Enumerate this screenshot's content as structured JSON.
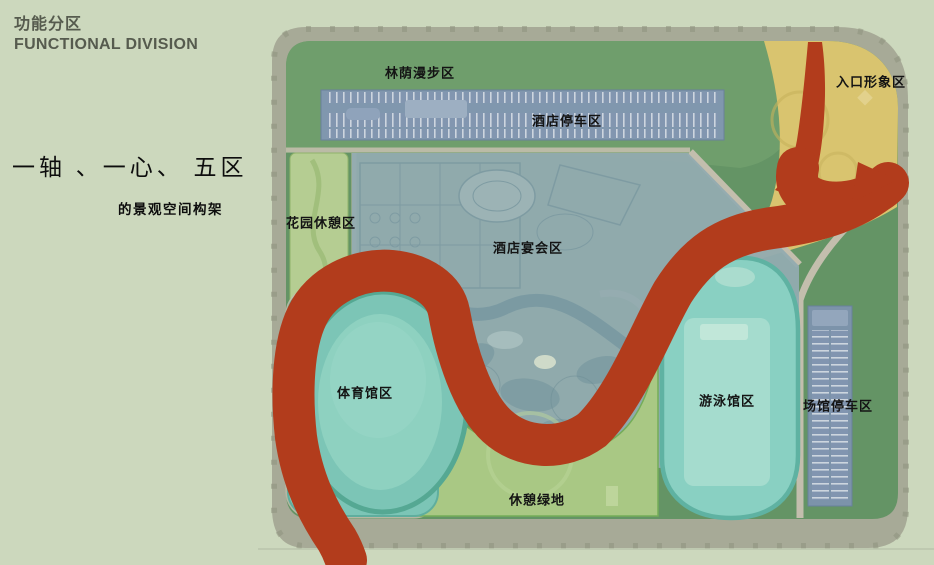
{
  "header": {
    "title_zh": "功能分区",
    "title_en": "FUNCTIONAL DIVISION"
  },
  "headline": {
    "main": "一轴 、一心、 五区",
    "sub": "的景观空间构架"
  },
  "plan": {
    "ribbon_color": "#b23c1c",
    "zones": [
      {
        "id": "stroll",
        "label": "林荫漫步区",
        "color": "#6f9e6c"
      },
      {
        "id": "hotel_parking",
        "label": "酒店停车区",
        "color": "#8197b2"
      },
      {
        "id": "entrance",
        "label": "入口形象区",
        "color": "#d9c46f"
      },
      {
        "id": "garden_rest",
        "label": "花园休憩区",
        "color": "#b5cd92"
      },
      {
        "id": "hotel_banquet",
        "label": "酒店宴会区",
        "color": "#92abb0"
      },
      {
        "id": "gymnasium",
        "label": "体育馆区",
        "color": "#7cc5b6"
      },
      {
        "id": "leisure_green",
        "label": "休憩绿地",
        "color": "#a9c884"
      },
      {
        "id": "swimming",
        "label": "游泳馆区",
        "color": "#89d0c2"
      },
      {
        "id": "venue_parking",
        "label": "场馆停车区",
        "color": "#7e93ae"
      }
    ]
  }
}
